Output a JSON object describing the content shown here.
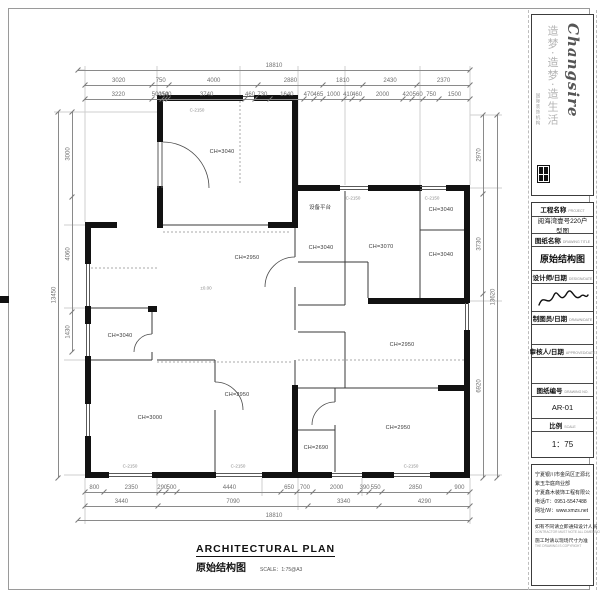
{
  "sheet": {
    "logo": {
      "brand": "Changsire",
      "slogan": "造梦·造梦·造生活",
      "tagline": "国际装饰机构"
    },
    "title_block": {
      "project_label": "工程名称",
      "project_label_en": "PROJECT",
      "project_value": "阅海湾壹号220户型图",
      "drawing_label": "图纸名称",
      "drawing_label_en": "DRAWING TITLE",
      "drawing_value": "原始结构图",
      "designer_label": "设计师/日期",
      "designer_label_en": "DESIGN/DATE",
      "draftsman_label": "制图员/日期",
      "draftsman_label_en": "DRAWN/DATE",
      "checker_label": "审核人/日期",
      "checker_label_en": "APPROVED/DATE",
      "number_label": "图纸编号",
      "number_label_en": "DRAWING NO.",
      "number_value": "AR-01",
      "scale_label": "比例",
      "scale_label_en": "SCALE",
      "scale_value": "1：75"
    },
    "company": {
      "address_line1": "宁夏银川市金凤区正源北街",
      "address_line2": "紫玉华庭商业部",
      "name": "宁夏鑫木装饰工程有限公司",
      "phone": "电话/T：0951-5547488",
      "web": "网址/W：www.xmzs.net",
      "note1": "如有不同请立即通知设计人员",
      "note1_en": "CONTRACTOR MUST NOTE ALL DIMENSIONS ON SITE",
      "note2": "施工时请以现场尺寸为准",
      "note2_en": "THE DRAWING IS COPYRIGHT"
    }
  },
  "footer": {
    "title_en": "ARCHITECTURAL PLAN",
    "title_cn": "原始结构图",
    "scale": "SCALE：1:75@A3"
  },
  "plan": {
    "equipment_label": "设备平台",
    "rooms": [
      {
        "label": "CH=3040"
      },
      {
        "label": "CH=2950"
      },
      {
        "label": "CH=3040"
      },
      {
        "label": "CH=3000"
      },
      {
        "label": "CH=2950"
      },
      {
        "label": "CH=3040"
      },
      {
        "label": "CH=3070"
      },
      {
        "label": "CH=3040"
      },
      {
        "label": "CH=3040"
      },
      {
        "label": "CH=2950"
      },
      {
        "label": "CH=2950"
      },
      {
        "label": "CH=2690"
      }
    ],
    "annotations": [
      {
        "text": "C-2150"
      },
      {
        "text": "C-2150"
      },
      {
        "text": "C-2150"
      },
      {
        "text": "±0.00"
      },
      {
        "text": "C-2150"
      },
      {
        "text": "C-2150"
      },
      {
        "text": "C-2150"
      }
    ]
  },
  "dims": {
    "top_overall": [
      18810
    ],
    "top_row2": [
      3020,
      750,
      4000,
      2880,
      1810,
      2430,
      2370
    ],
    "top_row3": [
      3220,
      500,
      150,
      140,
      3740,
      460,
      730,
      1640,
      470,
      465,
      1000,
      410,
      460,
      2000,
      420,
      560,
      750,
      1500
    ],
    "left_col": [
      3000,
      4060,
      1430
    ],
    "left_overall": [
      13450
    ],
    "right_col": [
      2970,
      3730,
      6920
    ],
    "right_overall": [
      13620
    ],
    "bottom_row1": [
      800,
      2350,
      290,
      500,
      4440,
      650,
      700,
      2000,
      390,
      550,
      2850,
      900
    ],
    "bottom_row2": [
      3440,
      7090,
      3340,
      4290
    ],
    "bottom_overall": [
      18810
    ]
  }
}
